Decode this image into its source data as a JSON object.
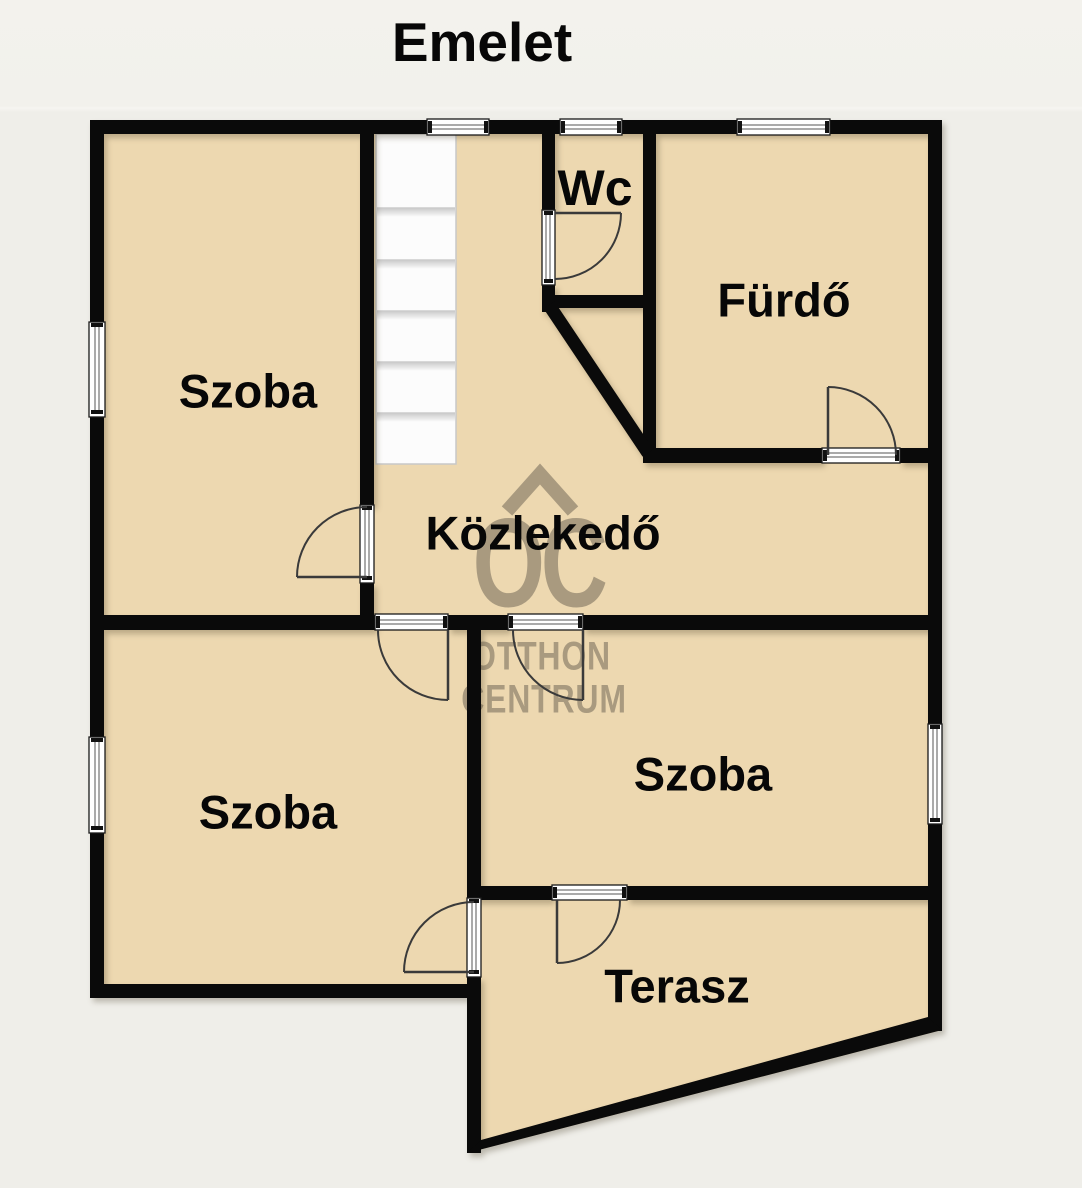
{
  "title": "Emelet",
  "rooms": {
    "room_top_left": {
      "label": "Szoba"
    },
    "wc": {
      "label": "Wc"
    },
    "bathroom": {
      "label": "Fürdő"
    },
    "hallway": {
      "label": "Közlekedő"
    },
    "room_bottom_left": {
      "label": "Szoba"
    },
    "room_middle_right": {
      "label": "Szoba"
    },
    "terrace": {
      "label": "Terasz"
    }
  },
  "watermark": {
    "monogram": "OC",
    "line1": "OTTHON",
    "line2": "CENTRUM"
  },
  "colors": {
    "background": "#efeee9",
    "floor": "#edd8b0",
    "wall": "#0a0a0a",
    "stairs": "#fcfcfc",
    "watermark": "#7c7260"
  }
}
